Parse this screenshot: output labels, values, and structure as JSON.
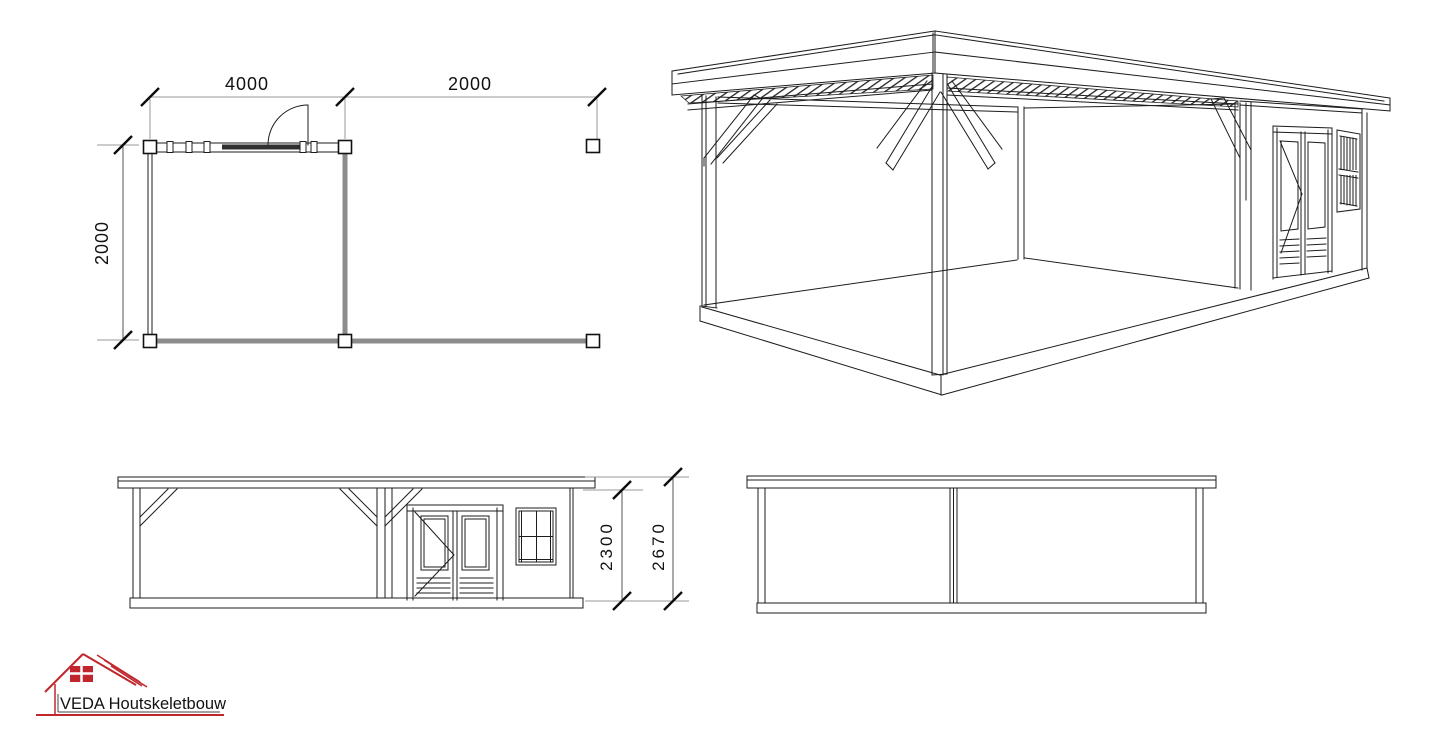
{
  "drawing": {
    "plan_view": {
      "dim_top_segment1": "4000",
      "dim_top_segment2": "2000",
      "dim_side": "2000"
    },
    "front_elevation": {
      "dim_wall_height": "2300",
      "dim_total_height": "2670"
    },
    "logo": {
      "company_name": "VEDA Houtskeletbouw"
    },
    "colors": {
      "line": "#1c1c1c",
      "thick_wall": "#8c8c8c",
      "dimension_line": "#9a9a9a",
      "glazing_band": "#2f2f2f",
      "logo_red": "#c0272d",
      "background": "#ffffff"
    }
  }
}
